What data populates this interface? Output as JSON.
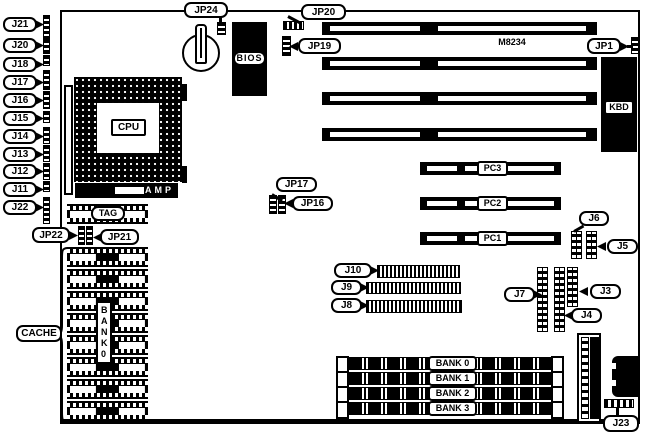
{
  "diagram_type": "motherboard-layout",
  "left_jumpers": [
    "J21",
    "J20",
    "J18",
    "J17",
    "J16",
    "J15",
    "J14",
    "J13",
    "J12",
    "J11",
    "J22"
  ],
  "jumpers": {
    "jp24": "JP24",
    "jp20": "JP20",
    "jp19": "JP19",
    "jp1": "JP1",
    "jp17": "JP17",
    "jp16": "JP16",
    "jp22": "JP22",
    "jp21": "JP21"
  },
  "connectors": {
    "j10": "J10",
    "j9": "J9",
    "j8": "J8",
    "j7": "J7",
    "j6": "J6",
    "j5": "J5",
    "j4": "J4",
    "j3": "J3",
    "j23": "J23"
  },
  "chips": {
    "cpu": "CPU",
    "amp": "AMP",
    "bios": "BIOS",
    "tag": "TAG",
    "kbd": "KBD",
    "chipset": "M8234"
  },
  "cache": {
    "label": "CACHE",
    "bank_vertical": "BANK0"
  },
  "pci_slots": [
    "PC3",
    "PC2",
    "PC1"
  ],
  "memory_banks": [
    "BANK 0",
    "BANK 1",
    "BANK 2",
    "BANK 3"
  ],
  "colors": {
    "ink": "#000000",
    "paper": "#ffffff"
  }
}
